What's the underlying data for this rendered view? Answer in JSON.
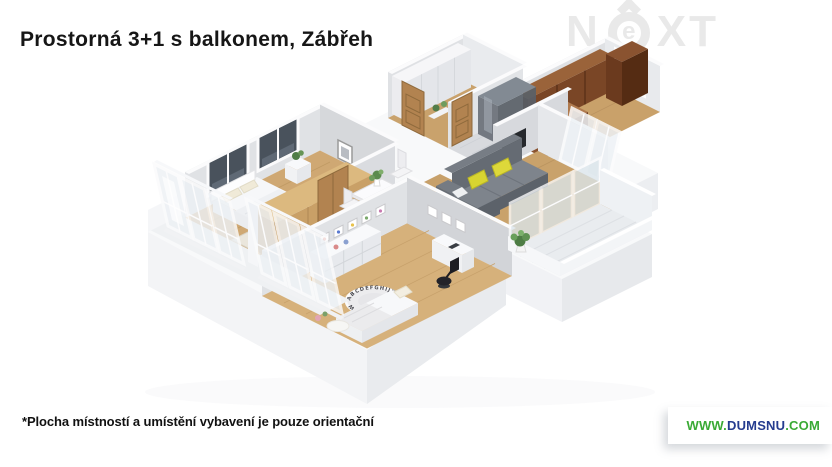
{
  "header": {
    "title": "Prostorná 3+1 s balkonem, Zábřeh"
  },
  "watermark": {
    "full": "NEXT",
    "letter_n": "N",
    "letter_e": "e",
    "letters_xt": "XT"
  },
  "floorplan": {
    "rug_letters": "ABCDEFGHIJKLMNOPQRSTUVWXYZ",
    "colors": {
      "floor_wood": "#cfa873",
      "wardrobe_wood": "#c9a067",
      "kitchen_walnut": "#7a4626",
      "sofa_gray": "#7e848c",
      "pillow_yellow": "#d8d431",
      "wall_face": "#e0e2e5",
      "wall_top": "#fbfbfc",
      "plinth": "#f3f4f6"
    }
  },
  "footer": {
    "disclaimer": "*Plocha místností a umístění vybavení je pouze orientační",
    "website": {
      "prefix": "WWW.",
      "name": "DUMSNU",
      "suffix": ".COM",
      "name_color": "#253c8f",
      "accent_color": "#3aaa35"
    }
  }
}
